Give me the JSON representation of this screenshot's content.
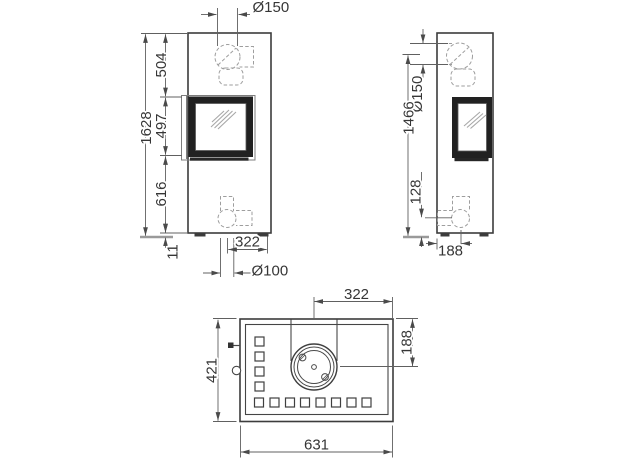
{
  "front_view": {
    "dims": {
      "flue_diameter": "Ø150",
      "upper_height": "504",
      "window_height": "497",
      "lower_height": "616",
      "total_height": "1628",
      "base_height": "11",
      "intake_offset": "322",
      "intake_diameter": "Ø100"
    }
  },
  "side_view": {
    "dims": {
      "flue_diameter": "Ø150",
      "flue_center_height": "1466",
      "intake_center_height": "128",
      "intake_offset": "188"
    }
  },
  "top_view": {
    "dims": {
      "flue_offset": "322",
      "flue_depth_offset": "188",
      "depth": "421",
      "width": "631"
    }
  }
}
